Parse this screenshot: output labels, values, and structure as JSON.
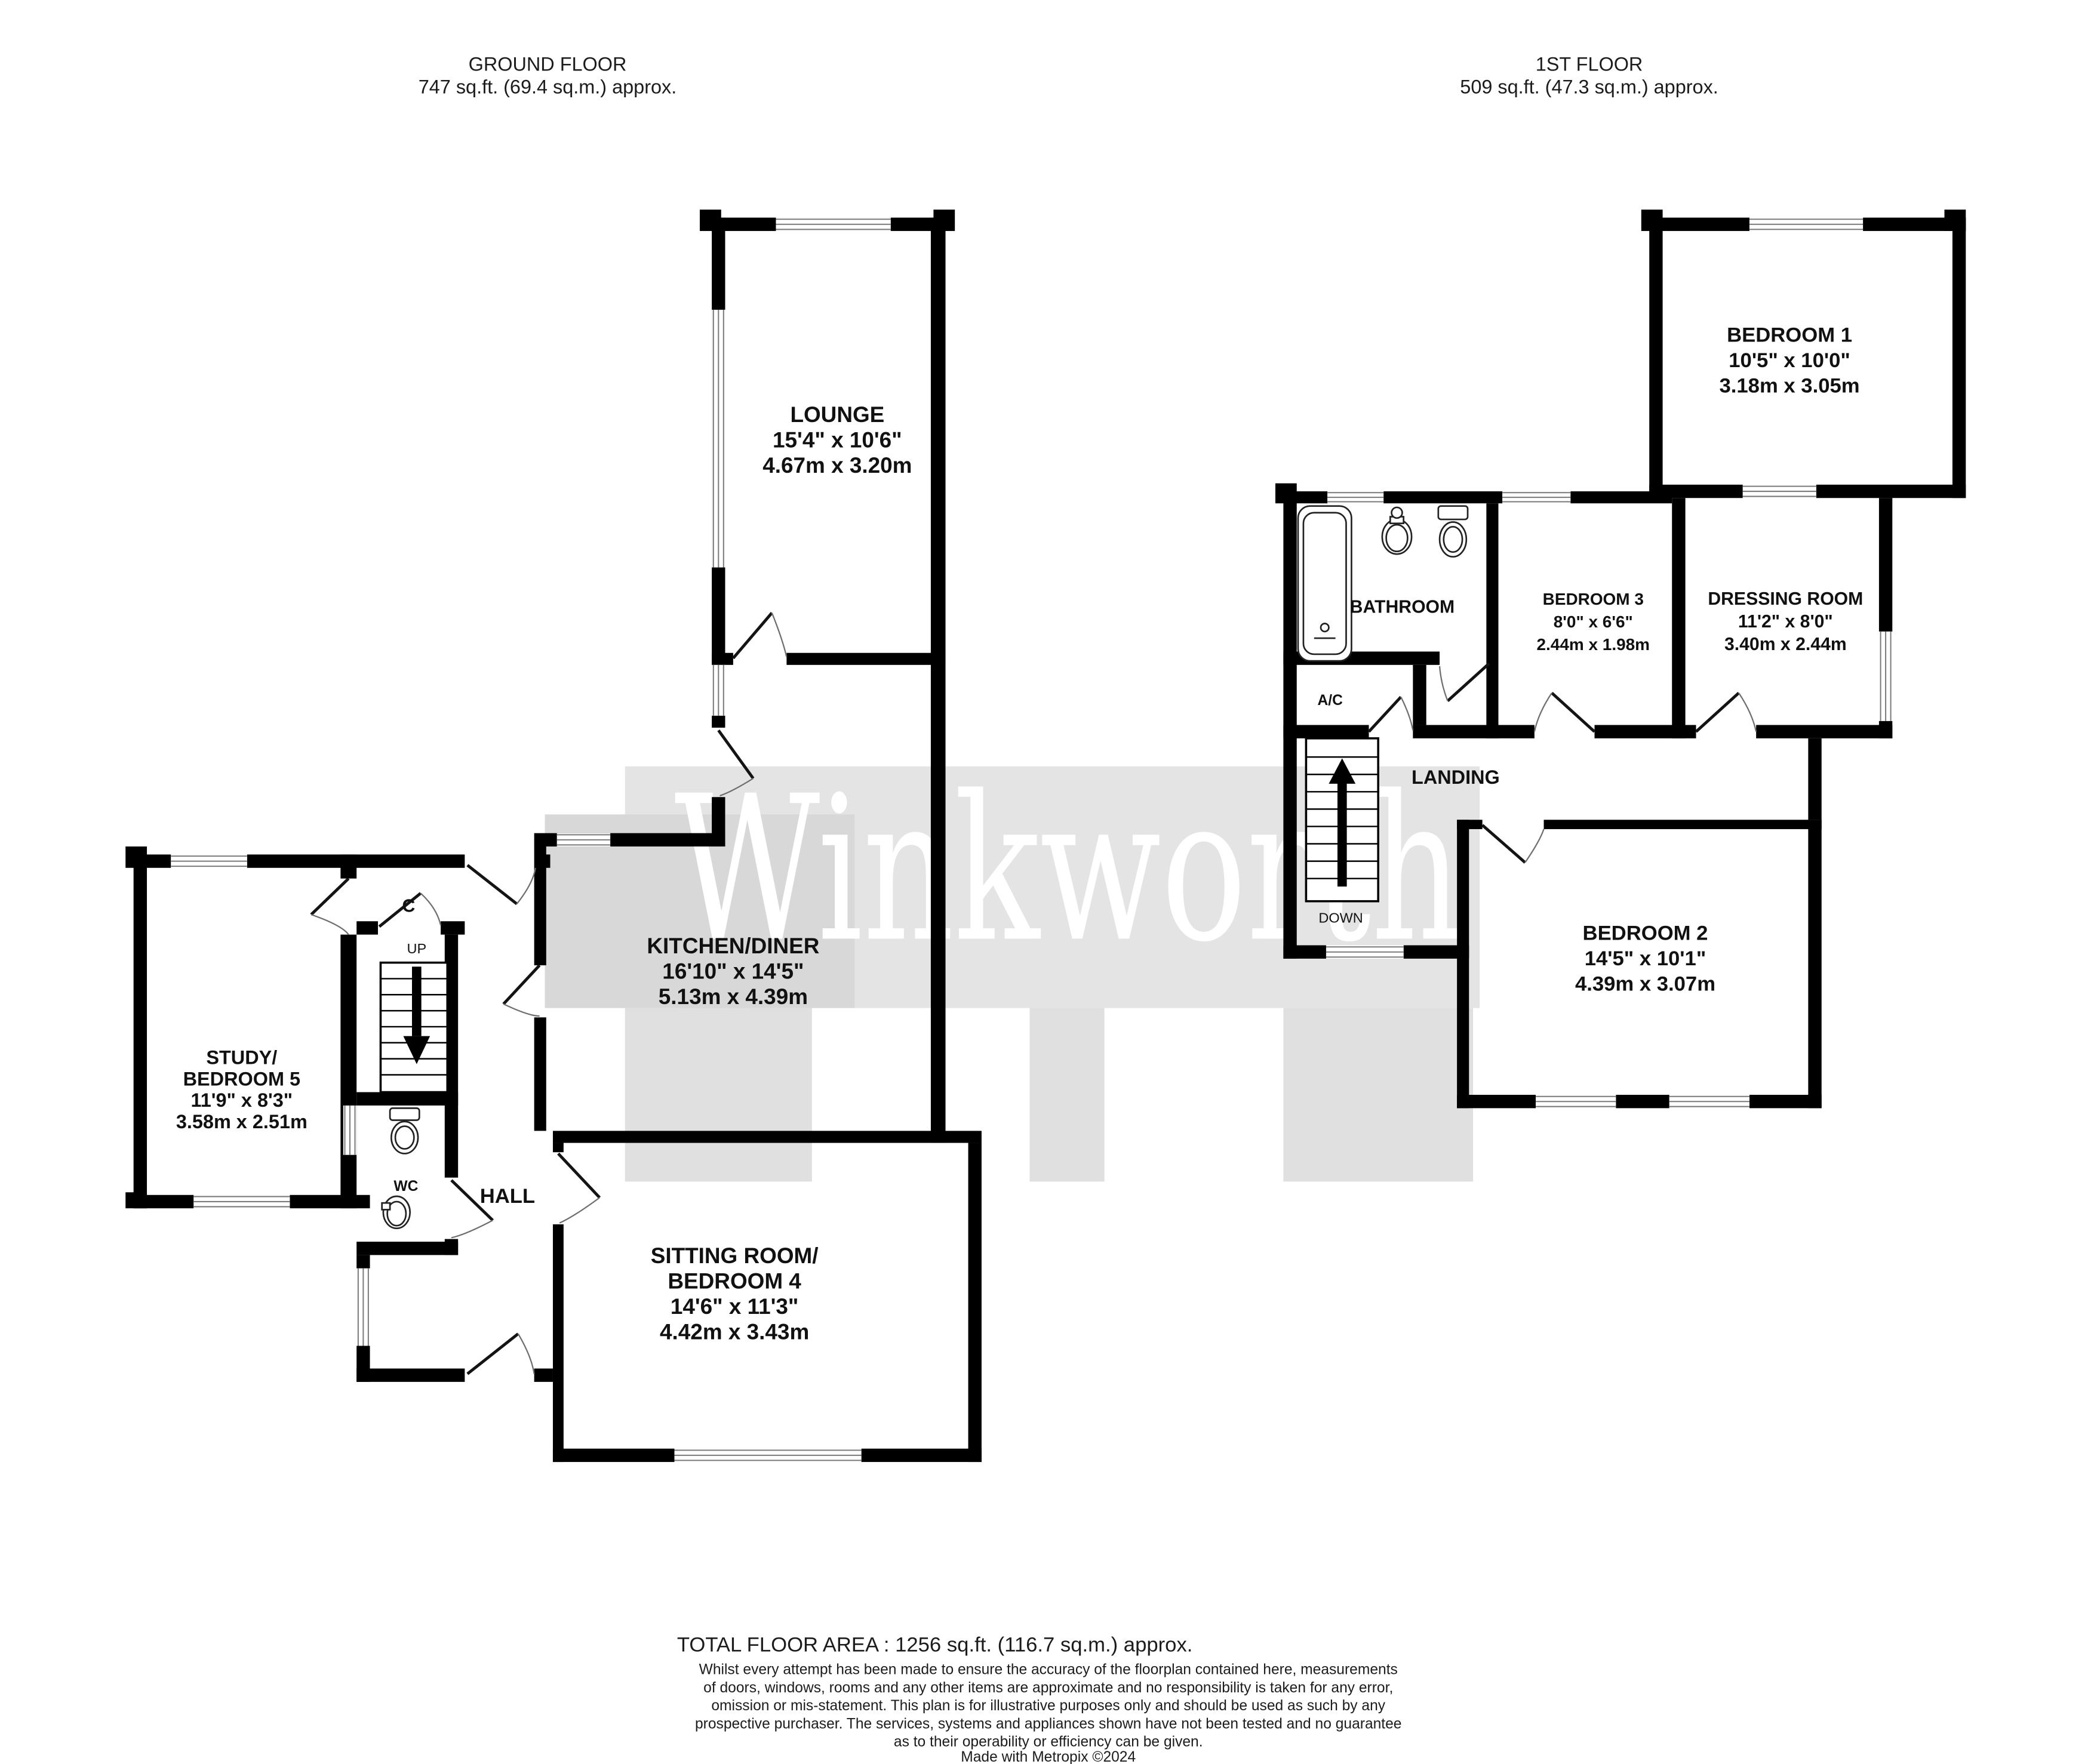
{
  "headers": {
    "ground": {
      "title": "GROUND FLOOR",
      "area": "747 sq.ft. (69.4 sq.m.) approx."
    },
    "first": {
      "title": "1ST FLOOR",
      "area": "509 sq.ft. (47.3 sq.m.) approx."
    }
  },
  "watermark": "Winkworth",
  "rooms": {
    "lounge": {
      "name": "LOUNGE",
      "imperial": "15'4\"  x 10'6\"",
      "metric": "4.67m  x 3.20m"
    },
    "kitchen": {
      "name": "KITCHEN/DINER",
      "imperial": "16'10\"  x 14'5\"",
      "metric": "5.13m  x 4.39m"
    },
    "study": {
      "name1": "STUDY/",
      "name2": "BEDROOM 5",
      "imperial": "11'9\"  x 8'3\"",
      "metric": "3.58m  x 2.51m"
    },
    "sitting": {
      "name1": "SITTING ROOM/",
      "name2": "BEDROOM 4",
      "imperial": "14'6\"  x 11'3\"",
      "metric": "4.42m  x 3.43m"
    },
    "hall": {
      "name": "HALL"
    },
    "wc": {
      "name": "WC"
    },
    "cupboard": {
      "name": "C"
    },
    "bedroom1": {
      "name": "BEDROOM 1",
      "imperial": "10'5\"  x 10'0\"",
      "metric": "3.18m  x 3.05m"
    },
    "bedroom2": {
      "name": "BEDROOM 2",
      "imperial": "14'5\"  x 10'1\"",
      "metric": "4.39m  x 3.07m"
    },
    "bedroom3": {
      "name": "BEDROOM 3",
      "imperial": "8'0\"  x 6'6\"",
      "metric": "2.44m  x 1.98m"
    },
    "dressing": {
      "name": "DRESSING ROOM",
      "imperial": "11'2\"  x 8'0\"",
      "metric": "3.40m  x 2.44m"
    },
    "bathroom": {
      "name": "BATHROOM"
    },
    "landing": {
      "name": "LANDING"
    },
    "ac": {
      "name": "A/C"
    }
  },
  "stairs": {
    "up_label": "UP",
    "down_label": "DOWN"
  },
  "footer": {
    "total": "TOTAL FLOOR AREA : 1256 sq.ft. (116.7 sq.m.) approx.",
    "disclaimer": [
      "Whilst every attempt has been made to ensure the accuracy of the floorplan contained here, measurements",
      "of doors, windows, rooms and any other items are approximate and no responsibility is taken for any error,",
      "omission or mis-statement. This plan is for illustrative purposes only and should be used as such by any",
      "prospective purchaser. The services, systems and appliances shown have not been tested and no guarantee",
      "as to their operability or efficiency can be given."
    ],
    "credit": "Made with Metropix ©2024"
  },
  "colors": {
    "wall": "#000000",
    "watermark_band": "#e4e4e4",
    "watermark_text": "#ffffff"
  }
}
